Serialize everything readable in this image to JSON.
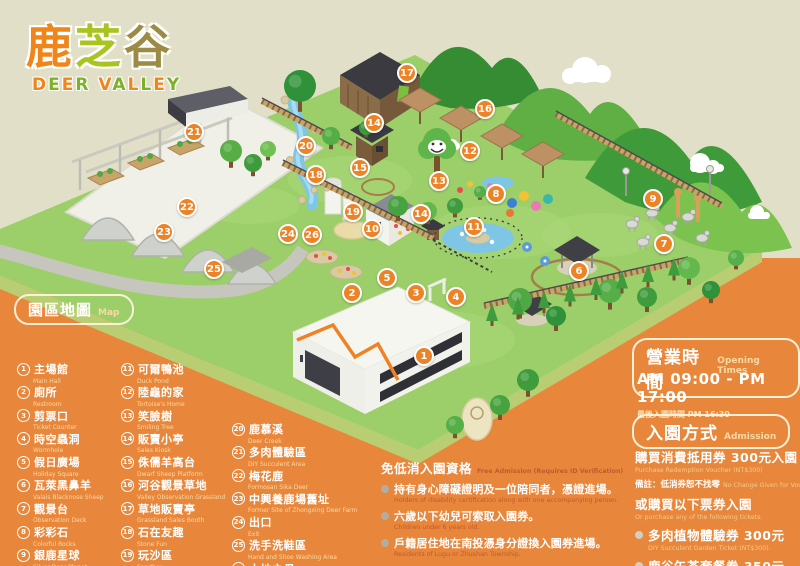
{
  "logo": {
    "zh": "鹿芝谷",
    "zh_colors": [
      "#F08519",
      "#A9C31F",
      "#9C8B45"
    ],
    "en": "DEER VALLEY",
    "en_colors": [
      "#F08519",
      "#7FB02A"
    ]
  },
  "colors": {
    "panel_orange": "#E8873B",
    "background_beige": "#E2DFC9",
    "marker_orange": "#EC8327",
    "legend_subtext": "#FAD9A4"
  },
  "legend": {
    "title_zh": "園區地圖",
    "title_en": "Map",
    "items": [
      {
        "n": "1",
        "zh": "主場館",
        "en": "Main Hall"
      },
      {
        "n": "2",
        "zh": "廁所",
        "en": "Restroom"
      },
      {
        "n": "3",
        "zh": "剪票口",
        "en": "Ticket Counter"
      },
      {
        "n": "4",
        "zh": "時空蟲洞",
        "en": "Wormhole"
      },
      {
        "n": "5",
        "zh": "假日廣場",
        "en": "Holiday Square"
      },
      {
        "n": "6",
        "zh": "瓦萊黑鼻羊",
        "en": "Valais Blacknose Sheep"
      },
      {
        "n": "7",
        "zh": "觀景台",
        "en": "Observation Deck"
      },
      {
        "n": "8",
        "zh": "彩彩石",
        "en": "Colorful Rocks"
      },
      {
        "n": "9",
        "zh": "銀鹿星球",
        "en": "Silver Deer Planet"
      },
      {
        "n": "10",
        "zh": "水豚的窩",
        "en": "Capybara's Nest"
      },
      {
        "n": "11",
        "zh": "可爾鴨池",
        "en": "Duck Pond"
      },
      {
        "n": "12",
        "zh": "陸龜的家",
        "en": "Tortoise's Home"
      },
      {
        "n": "13",
        "zh": "笑臉樹",
        "en": "Smiling Tree"
      },
      {
        "n": "14",
        "zh": "販賣小亭",
        "en": "Sales Kiosk"
      },
      {
        "n": "15",
        "zh": "侏儒羊高台",
        "en": "Dwarf Sheep Platform"
      },
      {
        "n": "16",
        "zh": "河谷觀景草地",
        "en": "Valley Observation Grassland"
      },
      {
        "n": "17",
        "zh": "草地販賣亭",
        "en": "Grassland Sales Booth"
      },
      {
        "n": "18",
        "zh": "石在友趣",
        "en": "Stone Fun"
      },
      {
        "n": "19",
        "zh": "玩沙區",
        "en": "Sandbox"
      },
      {
        "n": "20",
        "zh": "鹿慕溪",
        "en": "Deer Creek"
      },
      {
        "n": "21",
        "zh": "多肉體驗區",
        "en": "DIY Succulent Area"
      },
      {
        "n": "22",
        "zh": "梅花鹿",
        "en": "Formosan Sika Deer"
      },
      {
        "n": "23",
        "zh": "中興養鹿場舊址",
        "en": "Former Site of Zhongxing Deer Farm"
      },
      {
        "n": "24",
        "zh": "出口",
        "en": "Exit"
      },
      {
        "n": "25",
        "zh": "洗手洗鞋區",
        "en": "Hand and Shoe Washing Area"
      },
      {
        "n": "26",
        "zh": "大地之母",
        "en": "Mother Earth"
      }
    ]
  },
  "map": {
    "markers": [
      {
        "n": "1",
        "x": 424,
        "y": 356
      },
      {
        "n": "2",
        "x": 352,
        "y": 293
      },
      {
        "n": "3",
        "x": 416,
        "y": 293
      },
      {
        "n": "4",
        "x": 456,
        "y": 297
      },
      {
        "n": "5",
        "x": 387,
        "y": 278
      },
      {
        "n": "6",
        "x": 579,
        "y": 271
      },
      {
        "n": "7",
        "x": 664,
        "y": 244
      },
      {
        "n": "8",
        "x": 496,
        "y": 194
      },
      {
        "n": "9",
        "x": 653,
        "y": 199
      },
      {
        "n": "10",
        "x": 372,
        "y": 229
      },
      {
        "n": "11",
        "x": 474,
        "y": 227
      },
      {
        "n": "12",
        "x": 470,
        "y": 151
      },
      {
        "n": "13",
        "x": 439,
        "y": 181
      },
      {
        "n": "14",
        "x": 374,
        "y": 123
      },
      {
        "n": "14",
        "x": 421,
        "y": 214
      },
      {
        "n": "15",
        "x": 360,
        "y": 168
      },
      {
        "n": "16",
        "x": 485,
        "y": 109
      },
      {
        "n": "17",
        "x": 407,
        "y": 73
      },
      {
        "n": "18",
        "x": 316,
        "y": 175
      },
      {
        "n": "19",
        "x": 353,
        "y": 212
      },
      {
        "n": "20",
        "x": 306,
        "y": 146
      },
      {
        "n": "21",
        "x": 194,
        "y": 132
      },
      {
        "n": "22",
        "x": 187,
        "y": 207
      },
      {
        "n": "23",
        "x": 164,
        "y": 232
      },
      {
        "n": "24",
        "x": 288,
        "y": 234
      },
      {
        "n": "25",
        "x": 214,
        "y": 269
      },
      {
        "n": "26",
        "x": 312,
        "y": 235
      }
    ]
  },
  "hours": {
    "box_zh": "營業時間",
    "box_en": "Opening Times",
    "time": "AM 09:00 - PM 17:00",
    "last_entry": "最後入園時間 PM 16:30"
  },
  "admission": {
    "box_zh": "入園方式",
    "box_en": "Admission",
    "line1_zh": "購買消費抵用券 300元入園",
    "line1_en": "Purchase Redemption Voucher (NT$300)",
    "note_zh": "備註：低消券恕不找零",
    "note_en": "No Change Given for Voucher",
    "line2_zh": "或購買以下票券入園",
    "line2_en": "Or purchase any of the following tickets.",
    "tickets": [
      {
        "zh": "多肉植物體驗券 300元",
        "en": "DIY Succulent Garden Ticket (NT$300)."
      },
      {
        "zh": "鹿谷午茶套餐券 350元",
        "en": "Local Tea and Snack Ticket (NT$350)."
      }
    ]
  },
  "free_admission": {
    "title_zh": "免低消入園資格",
    "title_en": "Free Admission (Requires ID Verification)",
    "rules": [
      {
        "zh": "持有身心障礙證明及一位陪同者，憑證進場。",
        "en": "Holders of disability certification along with one accompanying person."
      },
      {
        "zh": "六歲以下幼兒可索取入園券。",
        "en": "Children under 6 years old."
      },
      {
        "zh": "戶籍居住地在南投憑身分證換入園券進場。",
        "en": "Residents of Lugu or Zhushan Township."
      }
    ]
  }
}
